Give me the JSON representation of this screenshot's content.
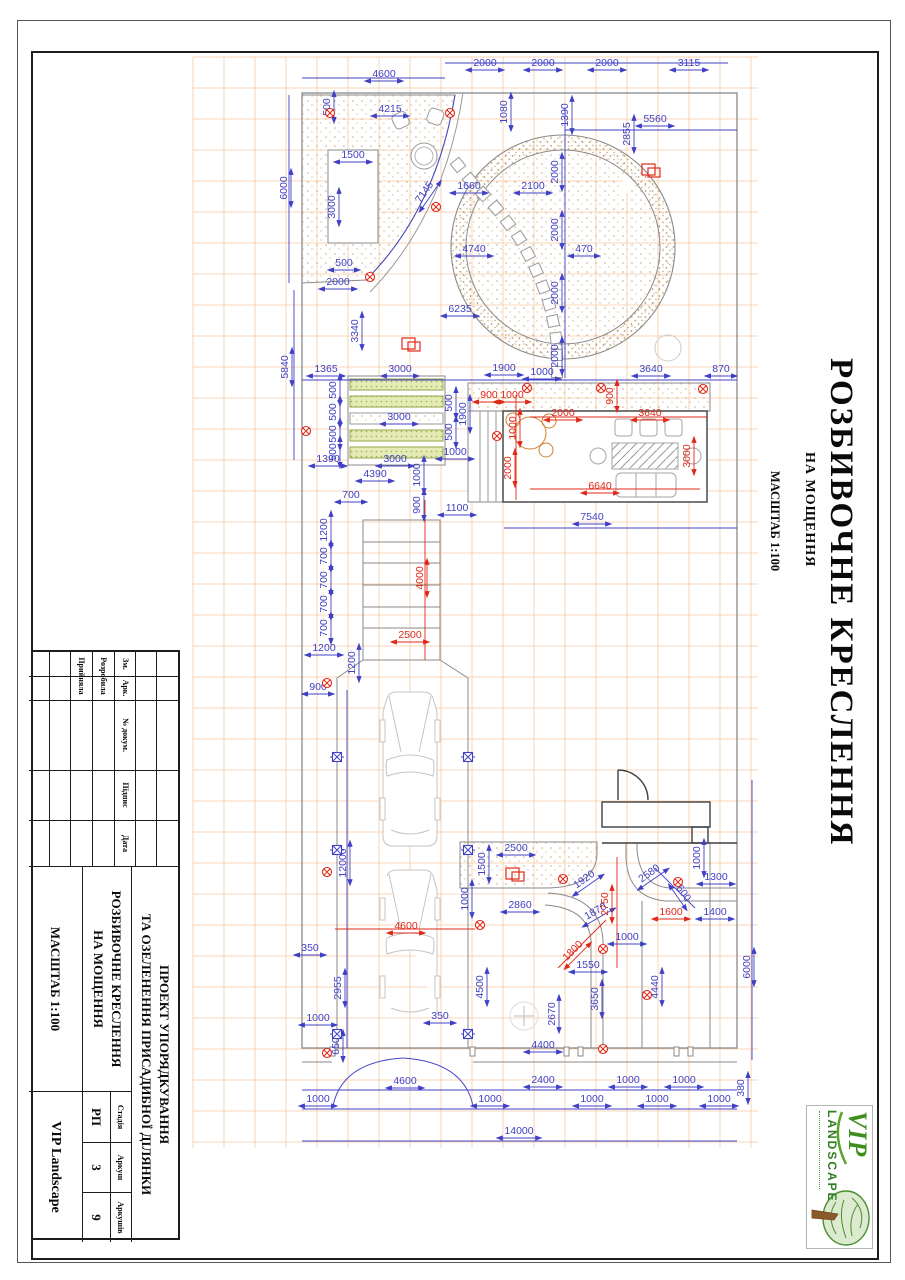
{
  "sheet": {
    "side_title": {
      "main": "РОЗБИВОЧНЕ КРЕСЛЕННЯ",
      "sub": "НА МОЩЕННЯ",
      "scale": "МАСШТАБ 1:100"
    },
    "title_block": {
      "project_line1": "ПРОЕКТ УПОРЯДКУВАННЯ",
      "project_line2": "ТА ОЗЕЛЕНЕННЯ ПРИСАДИБНОЇ ДІЛЯНКИ",
      "drawing_line1": "РОЗБИВОЧНЕ КРЕСЛЕННЯ",
      "drawing_line2": "НА МОЩЕННЯ",
      "scale": "МАСШТАБ 1:100",
      "col_zm": "Зм.",
      "col_ark": "Арк.",
      "col_doc": "№ докум.",
      "col_sign": "Підпис",
      "col_date": "Дата",
      "row_developed": "Розробила",
      "row_accepted": "Прийняла",
      "stage_label": "Стадія",
      "stage": "РП",
      "sheet_label": "Аркуш",
      "sheet": "3",
      "sheets_label": "Аркушів",
      "sheets": "9",
      "company": "VIP Landscape"
    },
    "logo": {
      "vip": "VIP",
      "landscape": "LANDSCAPE"
    }
  },
  "drawing": {
    "colors": {
      "dim_blue": "#4040c6",
      "dim_red": "#e02818",
      "grid": "#f6c9a2",
      "line_gray": "#8a8a8a",
      "line_dark": "#3f3f3f",
      "texture": "#c7ad80",
      "green_fill": "#e4ebb4",
      "green_dot": "#9fae52"
    },
    "dims": [
      [
        "4600",
        384,
        77,
        0,
        "b"
      ],
      [
        "2000",
        485,
        66,
        0,
        "b"
      ],
      [
        "2000",
        543,
        66,
        0,
        "b"
      ],
      [
        "2000",
        607,
        66,
        0,
        "b"
      ],
      [
        "3115",
        689,
        66,
        0,
        "b"
      ],
      [
        "500",
        330,
        107,
        -90,
        "b"
      ],
      [
        "4215",
        390,
        112,
        0,
        "b"
      ],
      [
        "1080",
        507,
        112,
        -90,
        "b"
      ],
      [
        "1390",
        568,
        115,
        -90,
        "b"
      ],
      [
        "5560",
        655,
        122,
        0,
        "b"
      ],
      [
        "2855",
        630,
        134,
        -90,
        "b"
      ],
      [
        "6000",
        287,
        188,
        -90,
        "b"
      ],
      [
        "1500",
        353,
        158,
        0,
        "b"
      ],
      [
        "3000",
        335,
        207,
        -90,
        "b"
      ],
      [
        "1660",
        469,
        189,
        0,
        "b"
      ],
      [
        "2100",
        533,
        189,
        0,
        "b"
      ],
      [
        "7145",
        427,
        194,
        -55,
        "b"
      ],
      [
        "2000",
        558,
        172,
        -90,
        "b"
      ],
      [
        "2000",
        558,
        230,
        -90,
        "b"
      ],
      [
        "2000",
        558,
        293,
        -90,
        "b"
      ],
      [
        "2000",
        558,
        356,
        -90,
        "b"
      ],
      [
        "4740",
        474,
        252,
        0,
        "b"
      ],
      [
        "470",
        584,
        252,
        0,
        "b"
      ],
      [
        "500",
        344,
        266,
        0,
        "b"
      ],
      [
        "2000",
        338,
        285,
        0,
        "b"
      ],
      [
        "6235",
        460,
        312,
        0,
        "b"
      ],
      [
        "3340",
        358,
        331,
        -90,
        "b"
      ],
      [
        "5840",
        288,
        367,
        -90,
        "b"
      ],
      [
        "1365",
        326,
        372,
        0,
        "b"
      ],
      [
        "3000",
        400,
        372,
        0,
        "b"
      ],
      [
        "1900",
        504,
        371,
        0,
        "b"
      ],
      [
        "1000",
        542,
        375,
        0,
        "b"
      ],
      [
        "3640",
        651,
        372,
        0,
        "b"
      ],
      [
        "870",
        721,
        372,
        0,
        "b"
      ],
      [
        "500",
        336,
        390,
        -90,
        "b"
      ],
      [
        "500",
        336,
        412,
        -90,
        "b"
      ],
      [
        "500",
        336,
        434,
        -90,
        "b"
      ],
      [
        "500",
        336,
        452,
        -90,
        "b"
      ],
      [
        "3000",
        399,
        420,
        0,
        "b"
      ],
      [
        "500",
        452,
        403,
        -90,
        "b"
      ],
      [
        "500",
        452,
        432,
        -90,
        "b"
      ],
      [
        "1900",
        466,
        414,
        -90,
        "b"
      ],
      [
        "1000",
        455,
        455,
        0,
        "b"
      ],
      [
        "1390",
        328,
        462,
        0,
        "b"
      ],
      [
        "3000",
        395,
        462,
        0,
        "b"
      ],
      [
        "4390",
        375,
        477,
        0,
        "b"
      ],
      [
        "1000",
        420,
        475,
        -90,
        "b"
      ],
      [
        "900",
        420,
        505,
        -90,
        "b"
      ],
      [
        "700",
        351,
        498,
        0,
        "b"
      ],
      [
        "1100",
        457,
        511,
        0,
        "b"
      ],
      [
        "900",
        489,
        398,
        0,
        "r"
      ],
      [
        "1000",
        512,
        398,
        0,
        "r"
      ],
      [
        "900",
        613,
        396,
        -90,
        "r"
      ],
      [
        "2000",
        563,
        416,
        0,
        "r"
      ],
      [
        "3640",
        650,
        416,
        0,
        "r"
      ],
      [
        "1000",
        516,
        428,
        -90,
        "r"
      ],
      [
        "2000",
        511,
        468,
        -90,
        "r"
      ],
      [
        "3000",
        690,
        456,
        -90,
        "r"
      ],
      [
        "6640",
        600,
        489,
        0,
        "r"
      ],
      [
        "7540",
        592,
        520,
        0,
        "b"
      ],
      [
        "1200",
        327,
        530,
        -90,
        "b"
      ],
      [
        "700",
        327,
        556,
        -90,
        "b"
      ],
      [
        "700",
        327,
        580,
        -90,
        "b"
      ],
      [
        "700",
        327,
        604,
        -90,
        "b"
      ],
      [
        "700",
        327,
        628,
        -90,
        "b"
      ],
      [
        "4000",
        423,
        578,
        -90,
        "r"
      ],
      [
        "2500",
        410,
        638,
        0,
        "r"
      ],
      [
        "1200",
        324,
        651,
        0,
        "b"
      ],
      [
        "1200",
        355,
        663,
        -90,
        "b"
      ],
      [
        "900",
        318,
        690,
        0,
        "b"
      ],
      [
        "12000",
        346,
        863,
        -90,
        "b"
      ],
      [
        "4600",
        406,
        929,
        0,
        "r"
      ],
      [
        "350",
        310,
        951,
        0,
        "b"
      ],
      [
        "2955",
        341,
        988,
        -90,
        "b"
      ],
      [
        "1000",
        318,
        1021,
        0,
        "b"
      ],
      [
        "650",
        339,
        1046,
        -90,
        "b"
      ],
      [
        "1000",
        318,
        1102,
        0,
        "b"
      ],
      [
        "2500",
        516,
        851,
        0,
        "b"
      ],
      [
        "1500",
        485,
        864,
        -90,
        "b"
      ],
      [
        "1000",
        468,
        899,
        -90,
        "b"
      ],
      [
        "2860",
        520,
        908,
        0,
        "b"
      ],
      [
        "1920",
        586,
        882,
        -35,
        "b"
      ],
      [
        "1870",
        597,
        914,
        -30,
        "b"
      ],
      [
        "2750",
        608,
        904,
        -90,
        "r"
      ],
      [
        "2580",
        651,
        876,
        -35,
        "b"
      ],
      [
        "600",
        681,
        895,
        55,
        "b"
      ],
      [
        "1000",
        700,
        858,
        -90,
        "b"
      ],
      [
        "1300",
        716,
        880,
        0,
        "b"
      ],
      [
        "1600",
        671,
        915,
        0,
        "r"
      ],
      [
        "1400",
        715,
        915,
        0,
        "b"
      ],
      [
        "1800",
        575,
        953,
        -45,
        "r"
      ],
      [
        "1000",
        627,
        940,
        0,
        "b"
      ],
      [
        "1550",
        588,
        968,
        0,
        "b"
      ],
      [
        "4500",
        483,
        987,
        -90,
        "b"
      ],
      [
        "2670",
        555,
        1014,
        -90,
        "b"
      ],
      [
        "3650",
        598,
        999,
        -90,
        "b"
      ],
      [
        "4440",
        658,
        987,
        -90,
        "b"
      ],
      [
        "6000",
        750,
        967,
        -90,
        "b"
      ],
      [
        "350",
        440,
        1019,
        0,
        "b"
      ],
      [
        "4400",
        543,
        1048,
        0,
        "b"
      ],
      [
        "4600",
        405,
        1084,
        0,
        "b"
      ],
      [
        "2400",
        543,
        1083,
        0,
        "b"
      ],
      [
        "1000",
        628,
        1083,
        0,
        "b"
      ],
      [
        "1000",
        684,
        1083,
        0,
        "b"
      ],
      [
        "380",
        744,
        1088,
        -90,
        "b"
      ],
      [
        "1000",
        490,
        1102,
        0,
        "b"
      ],
      [
        "1000",
        592,
        1102,
        0,
        "b"
      ],
      [
        "1000",
        657,
        1102,
        0,
        "b"
      ],
      [
        "1000",
        719,
        1102,
        0,
        "b"
      ],
      [
        "14000",
        519,
        1134,
        0,
        "b"
      ]
    ],
    "markers": {
      "red_cross": [
        [
          330,
          113
        ],
        [
          450,
          113
        ],
        [
          436,
          207
        ],
        [
          370,
          277
        ],
        [
          306,
          431
        ],
        [
          497,
          436
        ],
        [
          527,
          388
        ],
        [
          601,
          388
        ],
        [
          703,
          389
        ],
        [
          327,
          683
        ],
        [
          327,
          872
        ],
        [
          480,
          925
        ],
        [
          563,
          879
        ],
        [
          678,
          882
        ],
        [
          603,
          949
        ],
        [
          327,
          1053
        ],
        [
          603,
          1049
        ],
        [
          647,
          995
        ]
      ],
      "blue_square": [
        [
          337,
          757
        ],
        [
          468,
          757
        ],
        [
          337,
          850
        ],
        [
          468,
          850
        ],
        [
          337,
          1034
        ],
        [
          468,
          1034
        ]
      ],
      "red_double_square": [
        [
          652,
          172
        ],
        [
          412,
          346
        ],
        [
          516,
          876
        ]
      ]
    }
  }
}
